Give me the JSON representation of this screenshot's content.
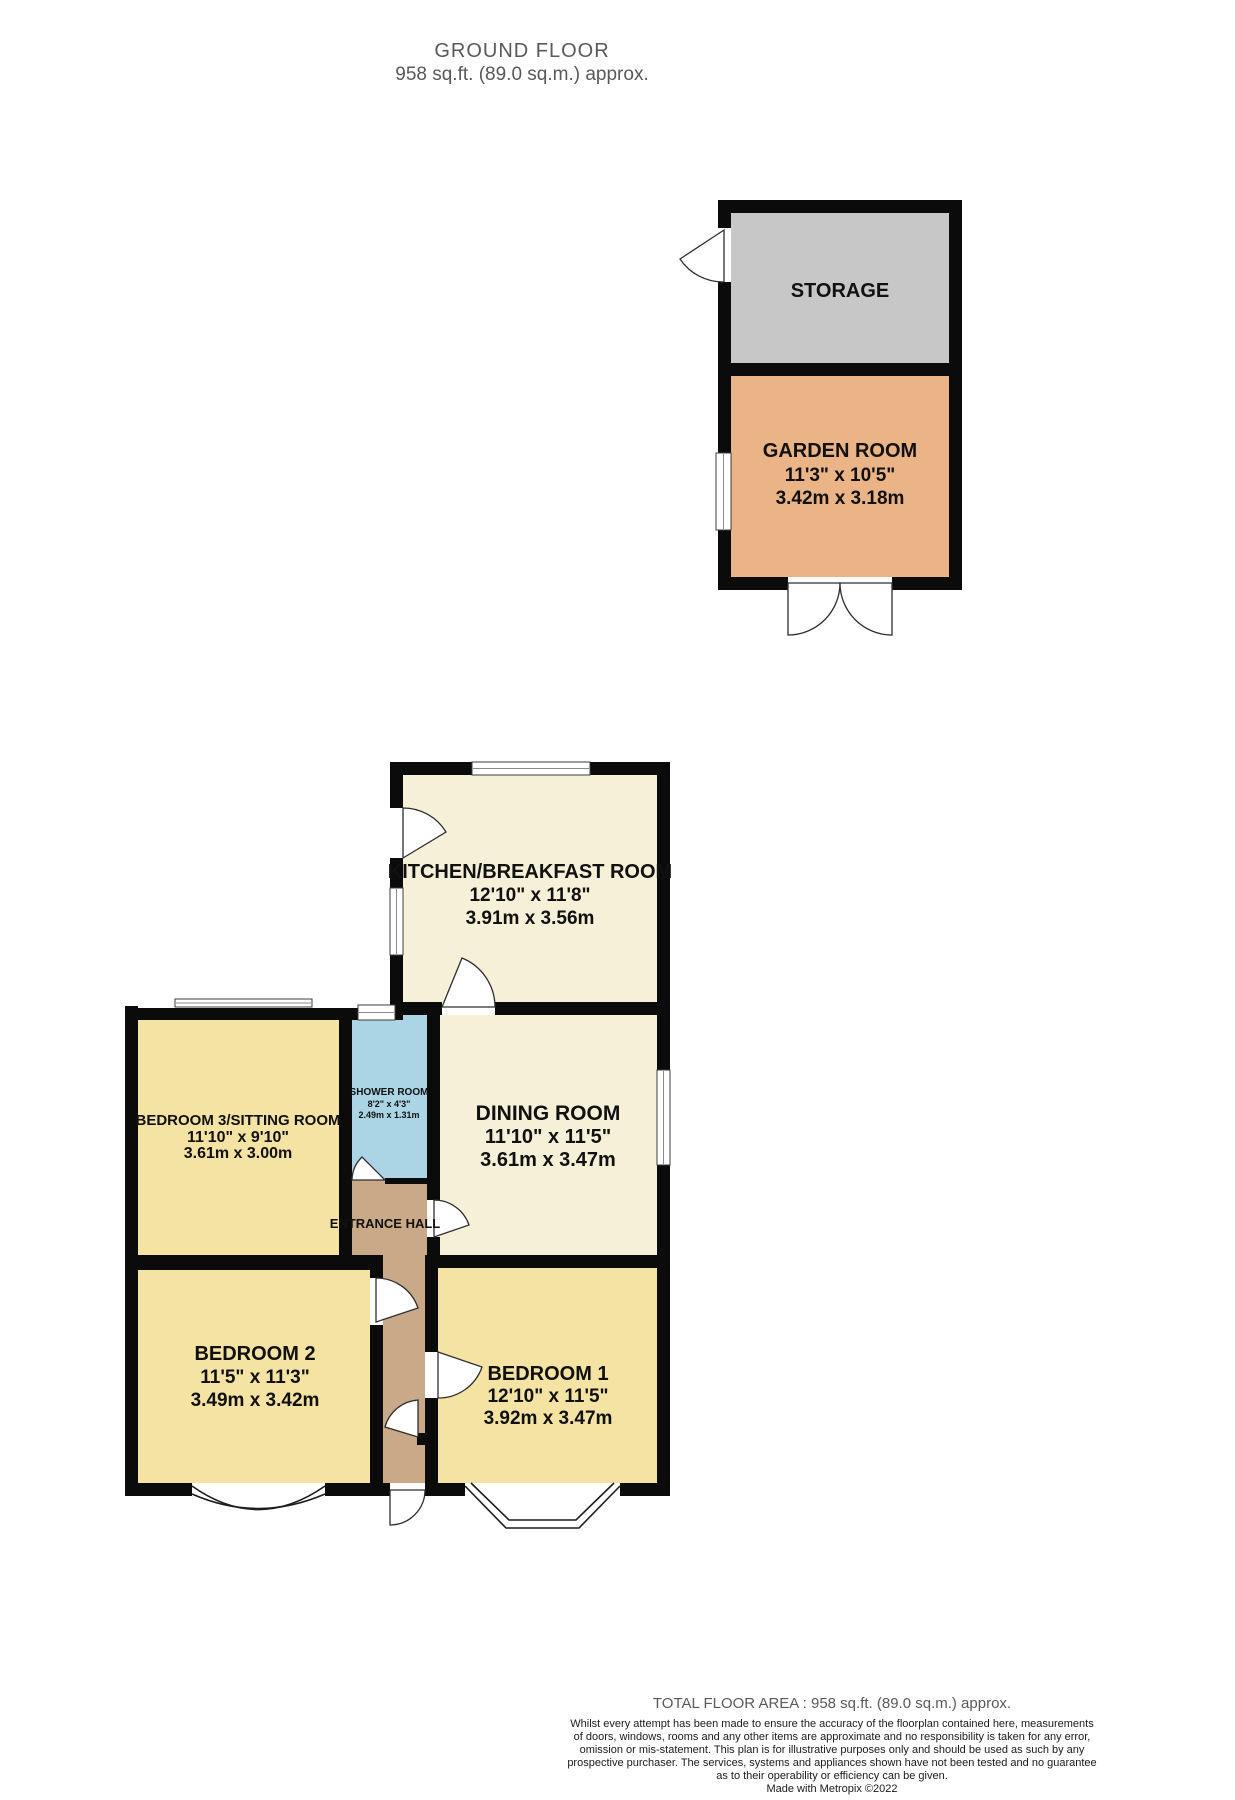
{
  "title": {
    "line1": "GROUND FLOOR",
    "line2": "958 sq.ft. (89.0 sq.m.) approx."
  },
  "rooms": {
    "storage": {
      "name": "STORAGE"
    },
    "garden": {
      "name": "GARDEN ROOM",
      "imperial": "11'3\" x 10'5\"",
      "metric": "3.42m x 3.18m"
    },
    "kitchen": {
      "name": "KITCHEN/BREAKFAST ROOM",
      "imperial": "12'10\" x 11'8\"",
      "metric": "3.91m x 3.56m"
    },
    "dining": {
      "name": "DINING ROOM",
      "imperial": "11'10\" x 11'5\"",
      "metric": "3.61m x 3.47m"
    },
    "bedroom3": {
      "name": "BEDROOM 3/SITTING ROOM",
      "imperial": "11'10\" x 9'10\"",
      "metric": "3.61m x 3.00m"
    },
    "shower": {
      "name": "SHOWER ROOM",
      "imperial": "8'2\" x 4'3\"",
      "metric": "2.49m x 1.31m"
    },
    "hall": {
      "name": "ENTRANCE HALL"
    },
    "bedroom2": {
      "name": "BEDROOM 2",
      "imperial": "11'5\" x 11'3\"",
      "metric": "3.49m x 3.42m"
    },
    "bedroom1": {
      "name": "BEDROOM 1",
      "imperial": "12'10\" x 11'5\"",
      "metric": "3.92m x 3.47m"
    }
  },
  "footer": {
    "total": "TOTAL FLOOR AREA : 958 sq.ft. (89.0 sq.m.) approx.",
    "disclaimer": [
      "Whilst every attempt has been made to ensure the accuracy of the floorplan contained here, measurements",
      "of doors, windows, rooms and any other items are approximate and no responsibility is taken for any error,",
      "omission or mis-statement. This plan is for illustrative purposes only and should be used as such by any",
      "prospective purchaser. The services, systems and appliances shown have not been tested and no guarantee",
      "as to their operability or efficiency can be given."
    ],
    "credit": "Made with Metropix ©2022"
  },
  "colors": {
    "wall": "#0b0b0b",
    "storage": "#c7c7c7",
    "garden": "#eab486",
    "cream": "#f6f0d8",
    "bedroom": "#f4e3a3",
    "shower": "#abd5e5",
    "hall": "#c9a987"
  }
}
